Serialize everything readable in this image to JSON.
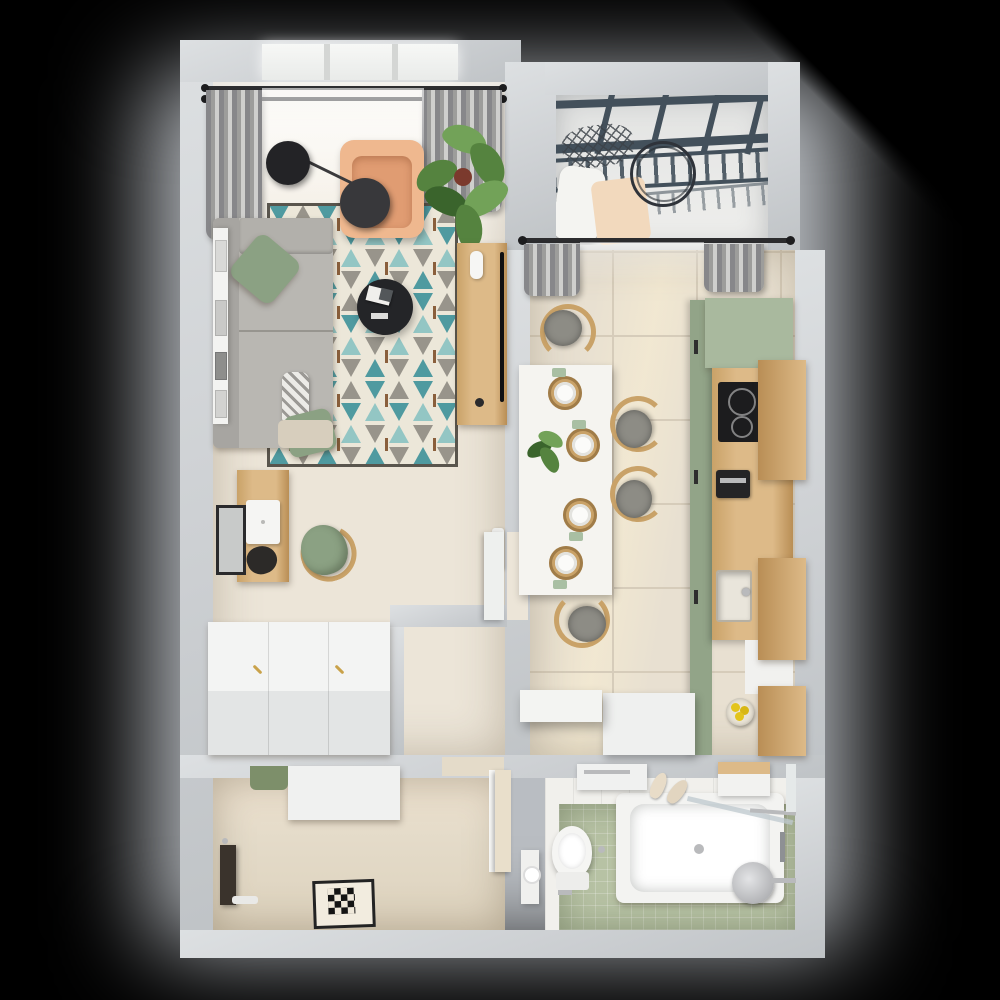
{
  "scene": {
    "type": "3d-floor-plan-render",
    "view": "top-down",
    "description": "Photorealistic top-down render of a one-bedroom apartment on a black background with a soft grey glow and a diagonal corner shadow"
  },
  "palette": {
    "bg": "#000000",
    "halo": "#b9bdc2",
    "wall": "#cdd0d3",
    "wallBright": "#dde0e2",
    "wallShade": "#bfc3c6",
    "floorWarm": "#ece5d8",
    "floorWarmLight": "#f6f1e7",
    "floorShower": "#e4dbc9",
    "tile": "#e8e0d1",
    "grout": "#d6ccba",
    "bathGreen": "#b7c2a4",
    "tileWhite": "#f1f0ec",
    "sofa": "#b9b7b2",
    "sofaDark": "#a7a5a1",
    "cushionBeige": "#d7cebd",
    "pillowGreen": "#8ba183",
    "patternGray": "#9b9995",
    "peach": "#efb88f",
    "peachDark": "#e09c72",
    "leaf": "#55833f",
    "leafDark": "#3a642c",
    "leafLight": "#72a258",
    "pot": "#7b3a2d",
    "rugCream": "#ece7d9",
    "rugTeal": "#4f9aa0",
    "rugTealLight": "#93c6c4",
    "rugGray": "#98948b",
    "rugBrown": "#8a5f3c",
    "rugBorder": "#59554d",
    "wood": "#ddba88",
    "woodDark": "#c9a268",
    "woodDeep": "#b98e55",
    "tableWhite": "#f5f4f0",
    "chairCush": "#8d8c85",
    "greenCab": "#a9b99e",
    "greenCabDark": "#92a488",
    "cooktop": "#1c1c1e",
    "chrome": "#b9babc",
    "steel": "#8e9094",
    "curtain": "#9d9d9b",
    "curtainDark": "#87878a",
    "glassFrame": "#43505b",
    "lamp": "#232326",
    "white": "#f4f5f3",
    "doorBeige": "#e9dfcb",
    "lemon": "#e3c41c"
  },
  "apartment": {
    "rooms": [
      {
        "name": "living-room",
        "furniture": [
          "window",
          "curtain-rod",
          "sheer-curtains",
          "pendant-lamps",
          "peach-armchair",
          "potted-plant",
          "grey-corner-sofa",
          "green-pillows",
          "patterned-pillow",
          "geometric-teal-rug",
          "black-round-coffee-table",
          "wood-tv-console",
          "tv",
          "wall-shelf-with-frames",
          "wood-desk",
          "laptop",
          "green-desk-chair",
          "wall-mirror",
          "radiator"
        ]
      },
      {
        "name": "hallway",
        "furniture": [
          "white-wardrobe-row",
          "open-white-door",
          "partition-wall"
        ]
      },
      {
        "name": "balcony",
        "furniture": [
          "glazed-roof",
          "hanging-net-chair",
          "round-hoop",
          "white-cushion",
          "peach-blanket"
        ]
      },
      {
        "name": "kitchen-dining",
        "furniture": [
          "curtain-rod",
          "grey-curtains",
          "white-dining-table",
          "four-place-settings",
          "centerpiece-plant",
          "four-wood-chairs",
          "sage-green-cabinets",
          "wood-countertop",
          "induction-cooktop",
          "coffee-machine",
          "sink",
          "wood-wall-cabinets",
          "lemon-bowl",
          "white-island-block",
          "floating-white-shelf"
        ]
      },
      {
        "name": "bathroom",
        "furniture": [
          "bathtub",
          "shower-head",
          "glass-screen",
          "toilet",
          "toilet-paper-holder",
          "slippers",
          "washer-top",
          "wall-cabinet",
          "mirror-strip",
          "towel-rail",
          "green-tile-floor"
        ]
      },
      {
        "name": "shower-room",
        "furniture": [
          "square-floor-drain",
          "dark-bench",
          "white-cabinet",
          "green-towel",
          "open-beige-door"
        ]
      }
    ]
  }
}
